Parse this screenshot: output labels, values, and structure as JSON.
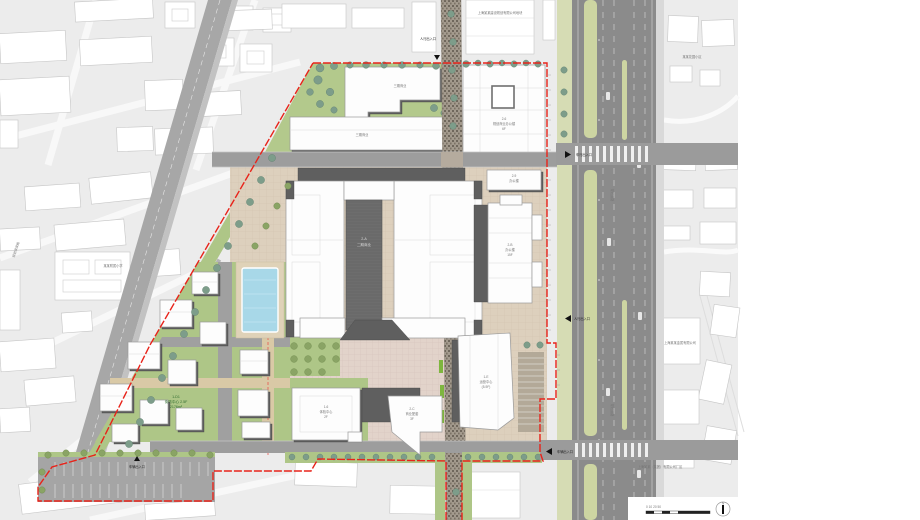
{
  "page": {
    "title": "项目总平面图"
  },
  "colors": {
    "context_bg": "#ececec",
    "site_green": "#aec687",
    "lawn_green": "#b3c98c",
    "plaza_beige": "#ddd0bd",
    "plaza_pink": "#e2d3ca",
    "road_gray": "#9d9d9d",
    "arterial_gray": "#8b8b8b",
    "median_green": "#cdd5a2",
    "boundary_red": "#e8231a",
    "pool_blue": "#a8d8e8",
    "building_white": "#fdfdfd",
    "building_dark": "#5f5f5f",
    "stone_path": "#a69d90"
  },
  "annotations": {
    "top_note": "上海某某建设规划有限公司地块",
    "school": "某某附属小学",
    "left_road": "规划某某路",
    "arterial_road": "规划道路",
    "context_right_a": "某某花园小区",
    "context_right_b": "上海某某金属有限公司",
    "context_right_c": "上海某某（集团）有限公司厂区",
    "north": "N",
    "scale_ticks": "0  10  20  50"
  },
  "buildings": {
    "phase3_a": {
      "name": "三期商业"
    },
    "phase3_b": {
      "name": "三期商业"
    },
    "b2_6": {
      "code": "2-6",
      "name": "规划商业办公楼",
      "floors": "6F"
    },
    "b2_9": {
      "code": "2-9",
      "name": "办公楼"
    },
    "b2_a": {
      "code": "2-A",
      "name": "二期商业"
    },
    "b2_b": {
      "code": "2-B",
      "name": "办公楼",
      "floors": "15F"
    },
    "b1_6": {
      "code": "1-6",
      "name": "体验中心",
      "floors": "2F"
    },
    "b2_c": {
      "code": "2-C",
      "name": "商业配套",
      "floors": "3F"
    },
    "b1_e": {
      "code": "1-E",
      "name": "运营中心",
      "floors": "(5-9F)"
    },
    "villa": {
      "code": "1-D1",
      "name": "街坊中心 2.5F",
      "area": "2176m²"
    }
  },
  "entrances": {
    "ped_top": "人行出入口",
    "veh_mid": "车行出入口",
    "ped_right": "人行出入口",
    "veh_right": "车辆出入口",
    "veh_bottom": "车辆出入口"
  }
}
